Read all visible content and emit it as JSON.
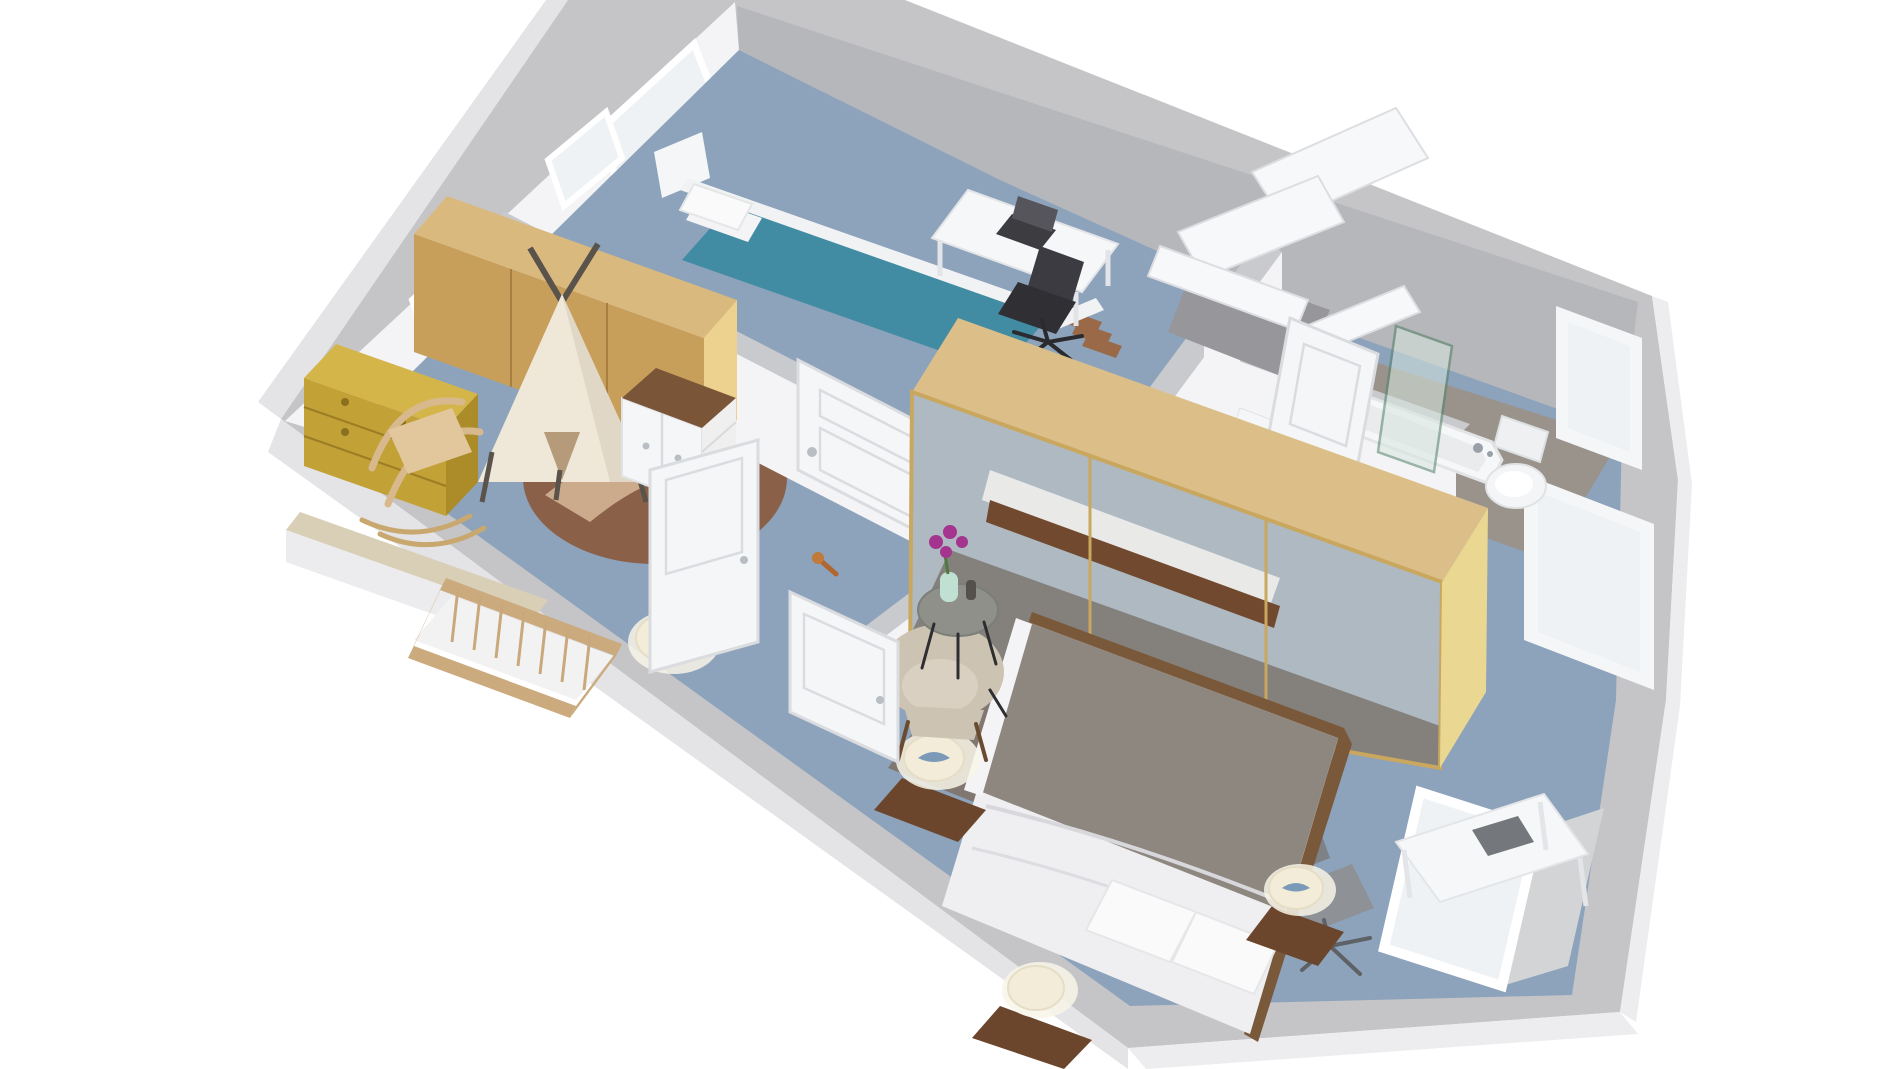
{
  "scene": {
    "type": "3d-floor-plan-render",
    "view": "axonometric-top-down",
    "description": "Rendered 3D floor plan of an upper storey: kids bedroom, nursery playroom, landing with staircase, bathroom and master bedroom with bay windows",
    "background": "#ffffff"
  },
  "palette": {
    "background": "#ffffff",
    "wallTop": "#c5c5c8",
    "wallOuter": "#e4e4e6",
    "wallOuterLight": "#ededef",
    "wallInnerWhite": "#f4f4f6",
    "wallInnerGray": "#b6b7ba",
    "wallTopInner": "#c9cacd",
    "carpet": "#8da3bb",
    "tile": "#99938c",
    "rugMaster": "#7f7770",
    "rugRound": "#8a6048",
    "rugPath": "#d3b493",
    "oakTop": "#dab97f",
    "oakFront": "#c89f5a",
    "oakEnd": "#ecd28e",
    "brassTop": "#d3b54a",
    "brassFront": "#c2a136",
    "brassSide": "#ab8c28",
    "teepee": "#efe8d9",
    "teepeeShade": "#e0d7c6",
    "teepeeDoor": "#b59b79",
    "pole": "#5a534c",
    "cribWood": "#cbaa7e",
    "mattress": "#f2f2f3",
    "white": "#f5f6f8",
    "walnutTop": "#7b5538",
    "walnutDark": "#6b462c",
    "tealBlanket": "#418ba3",
    "deskWhite": "#f6f7f9",
    "laptopDark": "#3c3c41",
    "chairBlack": "#2f2f34",
    "chairGray": "#8e9196",
    "wardrobeTop": "#dcbf88",
    "mirror": "#aeb9c2",
    "mirrorRug": "#7d766e",
    "mirrorFrame": "#c9a75f",
    "gable": "#ead792",
    "bedGray": "#8e8780",
    "duvet": "#efeff1",
    "bedFrame": "#7a593a",
    "armchair": "#cdc3b2",
    "armchairSeat": "#d9d0c1",
    "tableTop": "#8e9089",
    "vaseMint": "#bfe0d2",
    "orchid": "#a4348e",
    "lampShade": "#f3ecd9",
    "lampGlow": "#f8f4e8",
    "tub": "#f6f7f8",
    "tubInner": "#e9ebec",
    "chrome": "#9aa0a8",
    "glassGreen": "#d7e6df",
    "glassEdge": "#4f8066",
    "doorWhite": "#f5f6f8",
    "doorLine": "#dadce0",
    "glass": "#eef2f5",
    "stairTread": "#9a6a48",
    "stairHole": "#97979b",
    "railWhite": "#f7f8fa",
    "benchTop": "#d9ceb6"
  },
  "rooms": [
    {
      "name": "Kids bedroom",
      "furniture": [
        "single bed with teal bedding",
        "white headboard",
        "two windows",
        "white desk with laptop",
        "black office chair",
        "closed white door"
      ]
    },
    {
      "name": "Nursery playroom",
      "furniture": [
        "oak wardrobe",
        "brass chest of drawers",
        "teepee tent on round rug",
        "rattan rocking chair",
        "wooden crib",
        "changing table with walnut top",
        "floor lamp",
        "wooden toy",
        "open door",
        "window seat ledge",
        "window"
      ]
    },
    {
      "name": "Landing",
      "furniture": [
        "staircase with white railing",
        "wooden treads"
      ]
    },
    {
      "name": "Bathroom",
      "furniture": [
        "bathtub",
        "toilet",
        "glass shower screen",
        "vanity",
        "open door"
      ]
    },
    {
      "name": "Master bedroom",
      "furniture": [
        "double bed with gray blanket and white duvet",
        "mirrored sliding wardrobe with oak frame",
        "three walnut nightstands with white lamps",
        "beige armchair",
        "round side table with orchid",
        "gray rug",
        "white desk with laptop",
        "gray office chair",
        "bay windows",
        "open door"
      ]
    }
  ]
}
